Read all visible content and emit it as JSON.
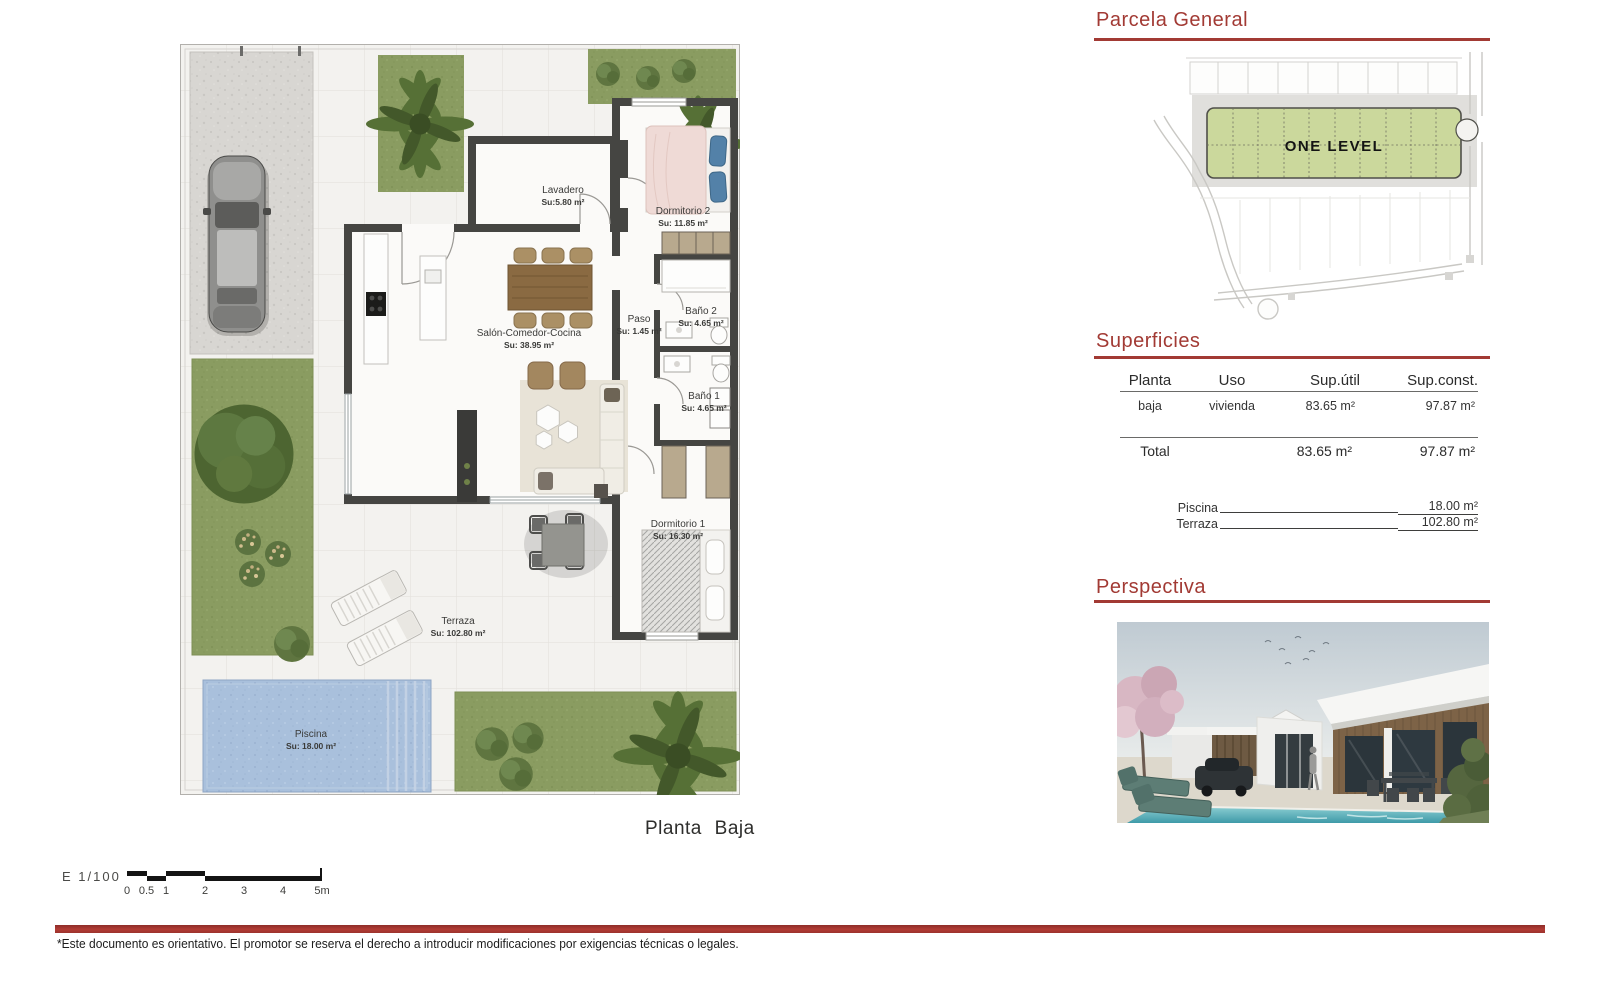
{
  "document": {
    "footer_note": "*Este documento es orientativo. El promotor se reserva el derecho a introducir modificaciones por exigencias técnicas o legales.",
    "accent_color": "#a23a34"
  },
  "floor_plan": {
    "caption": "Planta  Baja",
    "scale_label": "E  1/100",
    "scale_ticks": [
      "0",
      "0.5",
      "1",
      "2",
      "3",
      "4",
      "5m"
    ],
    "rooms": [
      {
        "name": "Lavadero",
        "area": "Su:5.80 m²"
      },
      {
        "name": "Dormitorio 2",
        "area": "Su: 11.85 m²"
      },
      {
        "name": "Salón-Comedor-Cocina",
        "area": "Su: 38.95 m²"
      },
      {
        "name": "Paso",
        "area": "Su: 1.45 m²"
      },
      {
        "name": "Baño 2",
        "area": "Su: 4.65 m²"
      },
      {
        "name": "Baño 1",
        "area": "Su: 4.65 m²"
      },
      {
        "name": "Dormitorio 1",
        "area": "Su: 16.30 m²"
      },
      {
        "name": "Terraza",
        "area": "Su: 102.80 m²"
      },
      {
        "name": "Piscina",
        "area": "Su: 18.00 m²"
      }
    ]
  },
  "parcela": {
    "title": "Parcela  General",
    "plot_label": "ONE  LEVEL"
  },
  "superficies": {
    "title": "Superficies",
    "headers": [
      "Planta",
      "Uso",
      "Sup.útil",
      "Sup.const."
    ],
    "row": {
      "planta": "baja",
      "uso": "vivienda",
      "sup_util": "83.65 m²",
      "sup_const": "97.87 m²"
    },
    "total": {
      "label": "Total",
      "sup_util": "83.65 m²",
      "sup_const": "97.87 m²"
    },
    "extras": [
      {
        "label": "Piscina",
        "value": "18.00 m²"
      },
      {
        "label": "Terraza",
        "value": "102.80 m²"
      }
    ]
  },
  "perspectiva": {
    "title": "Perspectiva"
  }
}
